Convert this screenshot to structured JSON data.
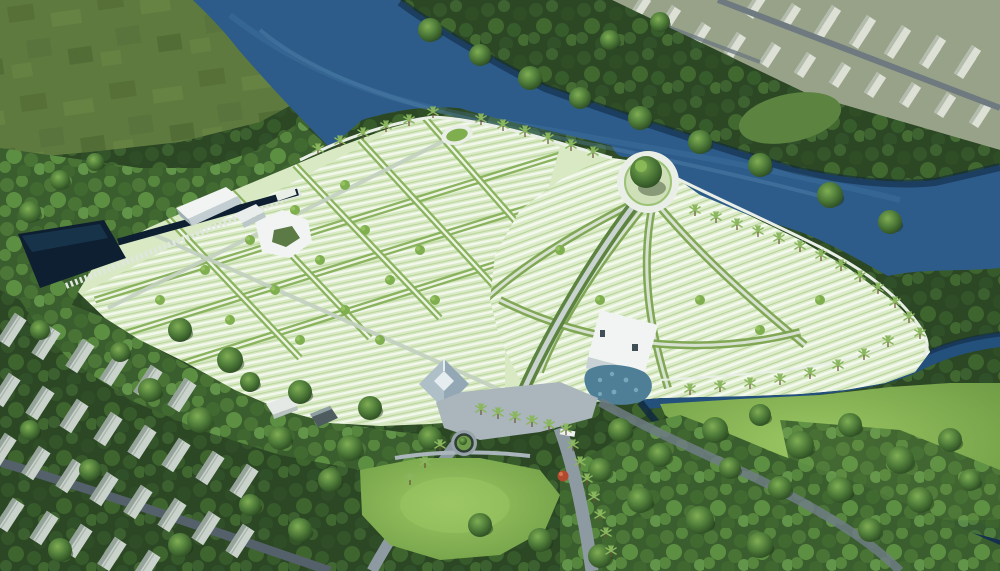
{
  "meta": {
    "title": "Aerial 3D rendering of a riverside memorial park master plan",
    "render_type": "architectural bird's-eye visualization",
    "visible_text": ""
  },
  "colors": {
    "forest_dark": "#2b4724",
    "forest_mid": "#3c602f",
    "forest_light": "#56813b",
    "field": "#5f7a3e",
    "lawn": "#79a84c",
    "lawn_bright": "#8fbe59",
    "river_deep": "#14304d",
    "river_mid": "#2d5c8a",
    "river_light": "#5d8cb3",
    "canal": "#0d1f30",
    "plot_base": "#d8e9c4",
    "plot_stripe": "#f3f8ec",
    "plot_lane": "#9cc276",
    "hedge": "#7fae4f",
    "road": "#8d9aa2",
    "road_dark": "#5f6d75",
    "plaza": "#aab6bb",
    "wall_white": "#e9efe7",
    "building_white": "#f1f4f2",
    "building_shade": "#c3ced2",
    "roof_slate": "#aebfc8",
    "pond_teal": "#4f7f96",
    "townhouse": "#c9d3cb",
    "townhouse_shade": "#97a49b",
    "city_block": "#dce0d5",
    "city_block_shade": "#b4bcae",
    "palm_green": "#8ab65e",
    "accent_red_tree": "#b0492e"
  },
  "scene": {
    "landmarks": [
      {
        "id": "grass-field",
        "label": "mottled grass field, upper left"
      },
      {
        "id": "river",
        "label": "dark blue river winding around the site"
      },
      {
        "id": "far-bank-forest",
        "label": "dense tree band on far river bank"
      },
      {
        "id": "city-blocks",
        "label": "white urban building blocks, upper right"
      },
      {
        "id": "burial-plot-grid",
        "label": "rectilinear burial plot blocks, west half"
      },
      {
        "id": "fan-plots",
        "label": "fan shaped plot sections radiating from river plaza"
      },
      {
        "id": "circular-tree-plaza",
        "label": "circular riverside plaza with large central tree"
      },
      {
        "id": "oval-viewpoint",
        "label": "white oval planter terrace on promenade"
      },
      {
        "id": "ceremony-hall",
        "label": "long white gable-roof hall"
      },
      {
        "id": "hexagonal-building",
        "label": "hexagonal courtyard building"
      },
      {
        "id": "memorial-building",
        "label": "white modern memorial block with mosaic pond"
      },
      {
        "id": "hip-roof-pavilion",
        "label": "square hip-roof temple pavilion"
      },
      {
        "id": "entrance-canopy",
        "label": "flat-roof entrance gate with green roof"
      },
      {
        "id": "roundabout",
        "label": "small tree roundabout at entrance"
      },
      {
        "id": "townhouse-rows",
        "label": "rows of townhouses, lower left"
      },
      {
        "id": "lawn-peninsula",
        "label": "tree-dotted lawn peninsula, lower right"
      },
      {
        "id": "nw-canal",
        "label": "dark canal along northwest boundary"
      }
    ]
  }
}
